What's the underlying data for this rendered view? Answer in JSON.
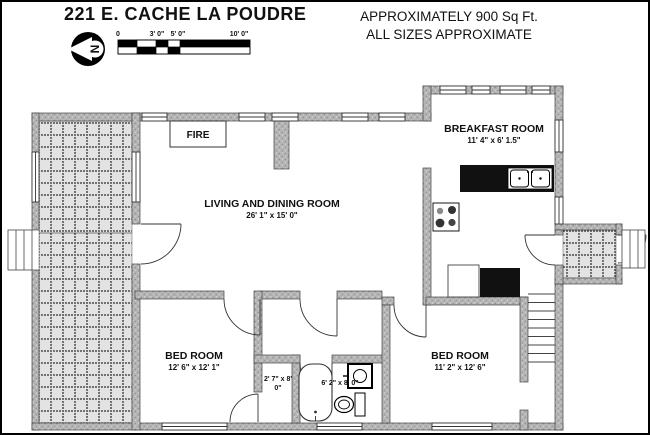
{
  "header": {
    "title": "221 E. CACHE LA POUDRE",
    "approx_line1": "APPROXIMATELY 900 Sq Ft.",
    "approx_line2": "ALL SIZES APPROXIMATE",
    "compass_letter": "N",
    "scale_labels": [
      "0",
      "3' 0\"",
      "5' 0\"",
      "10' 0\""
    ]
  },
  "rooms": {
    "living": {
      "name": "LIVING AND DINING ROOM",
      "dims": "26' 1\" x 15' 0\""
    },
    "breakfast": {
      "name": "BREAKFAST ROOM",
      "dims": "11' 4\" x 6' 1.5\""
    },
    "bedroom1": {
      "name": "BED ROOM",
      "dims": "12' 6\" x 12' 1\""
    },
    "bedroom2": {
      "name": "BED ROOM",
      "dims": "11' 2\" x 12' 6\""
    },
    "closet": {
      "dims_line1": "2' 7\" x 8'",
      "dims_line2": "0\""
    },
    "bathroom": {
      "dims": "6' 2\" x 8' 0\""
    },
    "fireplace": {
      "label": "FIRE"
    }
  },
  "colors": {
    "wall_gray": "#b5b5b5",
    "counter_black": "#111111",
    "patio_bg": "#e3e3e3",
    "line": "#333333",
    "paper": "#ffffff"
  }
}
